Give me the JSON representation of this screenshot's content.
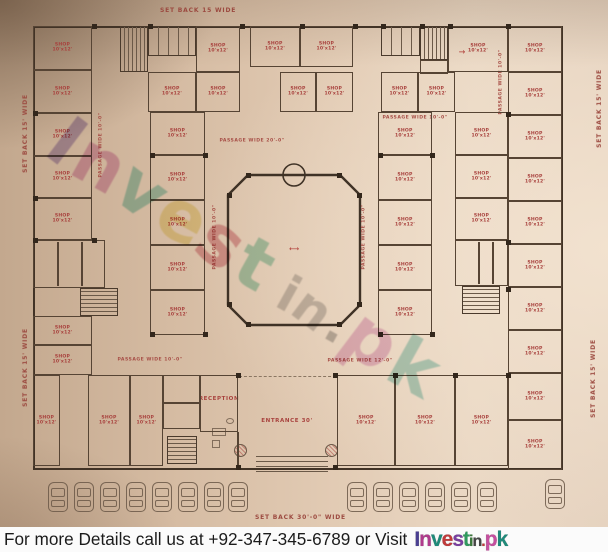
{
  "setbacks": {
    "top": "SET BACK 15 WIDE",
    "left": "SET BACK 15' WIDE",
    "right": "SET BACK 15' WIDE",
    "bottom": "SET BACK 30'-0\" WIDE"
  },
  "plan": {
    "unit_label": "SHOP",
    "unit_size": "10'x12'",
    "passages": {
      "p20": "PASSAGE WIDE 20'-0\"",
      "p12": "PASSAGE WIDE 12'-0\"",
      "p10": "PASSAGE WIDE 10'-0\""
    },
    "rooms": {
      "reception": "RECEPTION",
      "entrance": "ENTRANCE 30'"
    }
  },
  "watermark": {
    "text": "Invest in.pk",
    "letters": [
      {
        "ch": "I",
        "color": "#8a6fc0",
        "size": 70
      },
      {
        "ch": "n",
        "color": "#d078b8",
        "size": 70
      },
      {
        "ch": "v",
        "color": "#5fc0b0",
        "size": 70
      },
      {
        "ch": "e",
        "color": "#e8d868",
        "size": 70
      },
      {
        "ch": "s",
        "color": "#d06878",
        "size": 70
      },
      {
        "ch": "t",
        "color": "#68c0a0",
        "size": 70
      },
      {
        "ch": " ",
        "color": "#888888",
        "size": 70
      },
      {
        "ch": "i",
        "color": "#a0a0a0",
        "size": 50
      },
      {
        "ch": "n",
        "color": "#a0a0a0",
        "size": 50
      },
      {
        "ch": ".",
        "color": "#888888",
        "size": 50
      },
      {
        "ch": "p",
        "color": "#d890c8",
        "size": 70
      },
      {
        "ch": "k",
        "color": "#70c0b8",
        "size": 70
      }
    ]
  },
  "footer": {
    "message": "For more Details call us at +92-347-345-6789 or Visit",
    "logo_letters": [
      {
        "ch": "I",
        "color": "#4a3f92",
        "size": 21
      },
      {
        "ch": "n",
        "color": "#b03a8c",
        "size": 21
      },
      {
        "ch": "v",
        "color": "#1f8a7a",
        "size": 21
      },
      {
        "ch": "e",
        "color": "#c03a3a",
        "size": 21
      },
      {
        "ch": "s",
        "color": "#7a3fa0",
        "size": 21
      },
      {
        "ch": "t",
        "color": "#2f9a5f",
        "size": 21
      },
      {
        "ch": "i",
        "color": "#3a7a3a",
        "size": 16
      },
      {
        "ch": "n",
        "color": "#444444",
        "size": 16
      },
      {
        "ch": ".",
        "color": "#c03a3a",
        "size": 16
      },
      {
        "ch": "p",
        "color": "#c74fa0",
        "size": 21
      },
      {
        "ch": "k",
        "color": "#1f8a7a",
        "size": 21
      }
    ]
  },
  "colors": {
    "paper": "#d9c2ab",
    "wall": "#4a3a2c",
    "label_red": "#a8413d",
    "footer_bg": "#fbfbfb",
    "footer_text": "#1c1c1c"
  }
}
